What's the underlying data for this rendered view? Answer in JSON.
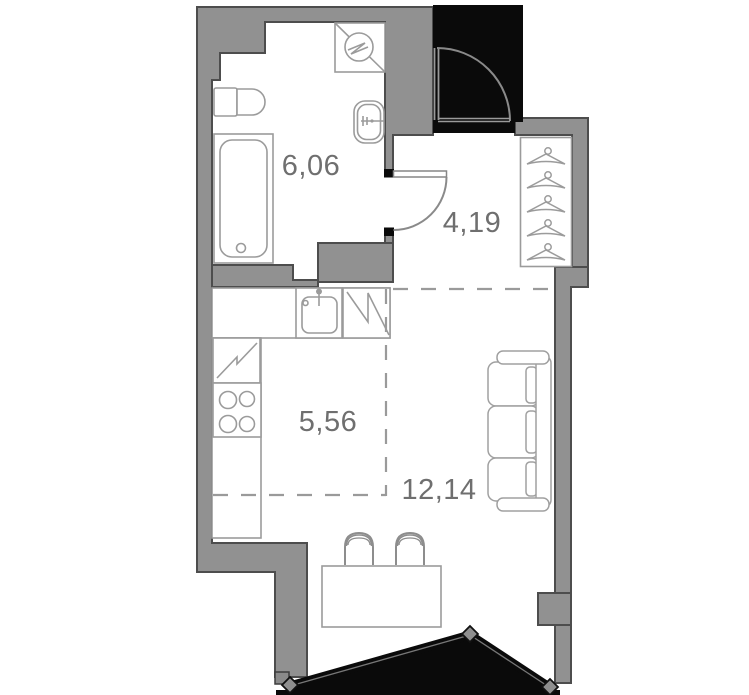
{
  "plan": {
    "title": "studio-apartment-floor-plan",
    "rooms": [
      {
        "name": "bathroom",
        "area": "6,06"
      },
      {
        "name": "hallway",
        "area": "4,19"
      },
      {
        "name": "kitchen",
        "area": "5,56"
      },
      {
        "name": "living-room",
        "area": "12,14"
      }
    ],
    "colors": {
      "wall_fill": "#919191",
      "wall_outline": "#4d4d4d",
      "core_black": "#0a0a0a",
      "furniture_stroke": "#9b9b9b",
      "label_text": "#6f6f6f",
      "background": "#ffffff"
    }
  }
}
